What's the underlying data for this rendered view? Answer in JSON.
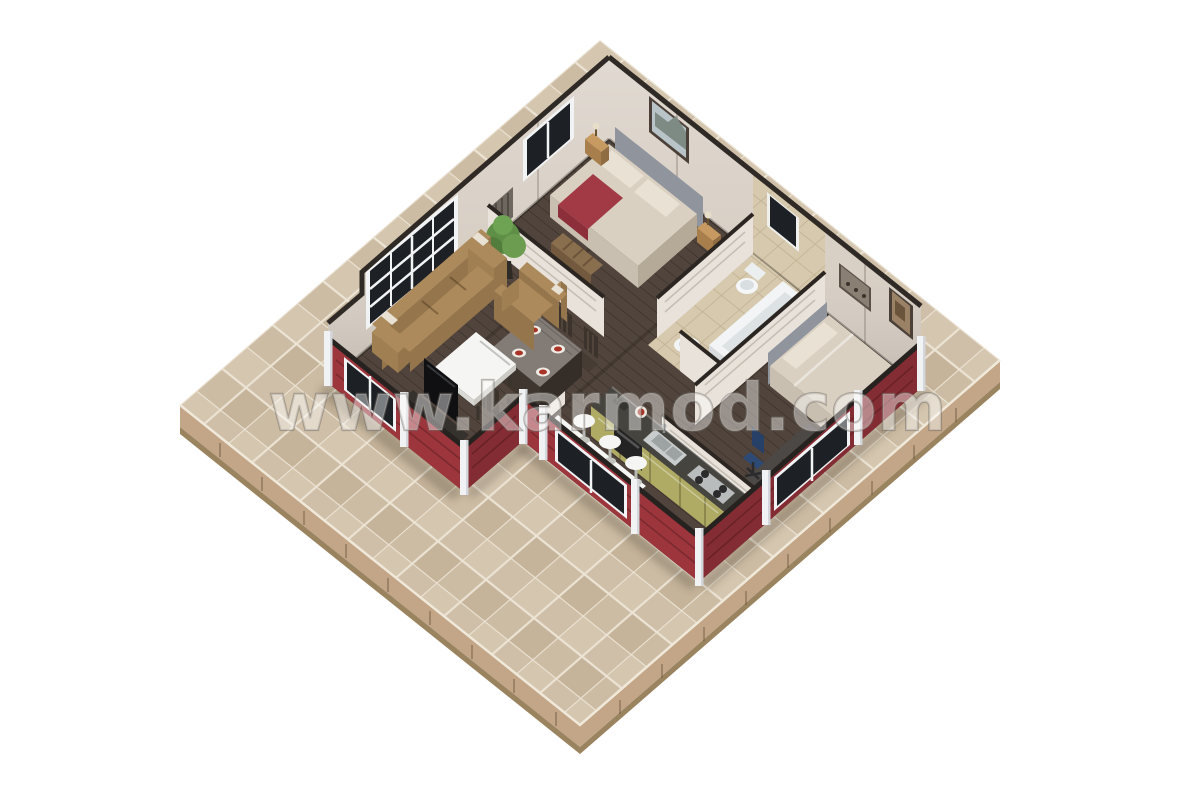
{
  "watermark": {
    "text": "www.karmod.com"
  },
  "scene": {
    "type": "isometric-3d-floor-plan-render",
    "rooms": [
      {
        "name": "living-room",
        "furniture": [
          "tan-sofa",
          "tan-armchair",
          "white-coffee-table",
          "tv-stand",
          "tv",
          "large-grid-window"
        ]
      },
      {
        "name": "dining-area",
        "furniture": [
          "dark-dining-table",
          "four-dining-chairs",
          "four-food-plates",
          "potted-plant"
        ]
      },
      {
        "name": "master-bedroom",
        "furniture": [
          "double-bed",
          "red-throw-blanket",
          "gray-headboard",
          "two-nightstands",
          "two-lamps",
          "wall-picture",
          "white-dresser",
          "wood-bench",
          "radiator",
          "small-window"
        ]
      },
      {
        "name": "bathroom",
        "furniture": [
          "toilet",
          "bathtub",
          "round-basin",
          "tiled-walls",
          "dark-window"
        ]
      },
      {
        "name": "bedroom",
        "furniture": [
          "double-bed",
          "gray-headboard",
          "white-pillow",
          "office-desk",
          "laptop",
          "blue-office-chair",
          "wall-niche-shelf",
          "wall-picture"
        ]
      },
      {
        "name": "kitchen",
        "furniture": [
          "olive-cabinet-run",
          "dark-counter",
          "steel-sink",
          "gas-hob",
          "oven",
          "counter-appliance"
        ]
      },
      {
        "name": "breakfast-area",
        "furniture": [
          "white-wall-table",
          "three-white-stools",
          "low-window-band"
        ]
      }
    ],
    "exterior": [
      "beige-stone-tile-patio",
      "layered-platform-edge",
      "red-panel-perimeter-walls",
      "white-corner-posts",
      "dark-top-rails",
      "tall-beige-back-walls",
      "dark-wall-trim"
    ]
  },
  "colors": {
    "background": "#ffffff",
    "tile_base": "#cdbca4",
    "tile_grout": "#ece4d5",
    "platform_side": "#c2a687",
    "platform_side_dark": "#9a835f",
    "wall_beige": "#d8cfc5",
    "wall_trim": "#2f2a25",
    "red_wall": "#9c353c",
    "red_wall_dark": "#842c33",
    "top_rail": "#26221f",
    "post_white": "#f1f2f3",
    "floor_wood": "#50443c",
    "bathroom_tile": "#d6c9ad",
    "window_glass": "#1d2125",
    "window_frame": "#f2f3f4",
    "bed_linen": "#d9d0c1",
    "pillow": "#e8e1d4",
    "throw_red": "#a23a45",
    "headboard": "#8f949d",
    "nightstand_wood": "#c69a60",
    "sofa_tan": "#ad8a5b",
    "sofa_tan_dark": "#95764c",
    "furniture_white": "#f5f5f3",
    "tv_black": "#141417",
    "dining_table_top": "#837c76",
    "plant_green": "#5f8f46",
    "cabinet_olive": "#afab65",
    "counter_dark": "#45443f",
    "steel": "#c9cccc",
    "desk_gray": "#4c4845",
    "chair_blue": "#2d4a75",
    "partition": "#e8e2da",
    "food_red": "#a93326"
  }
}
